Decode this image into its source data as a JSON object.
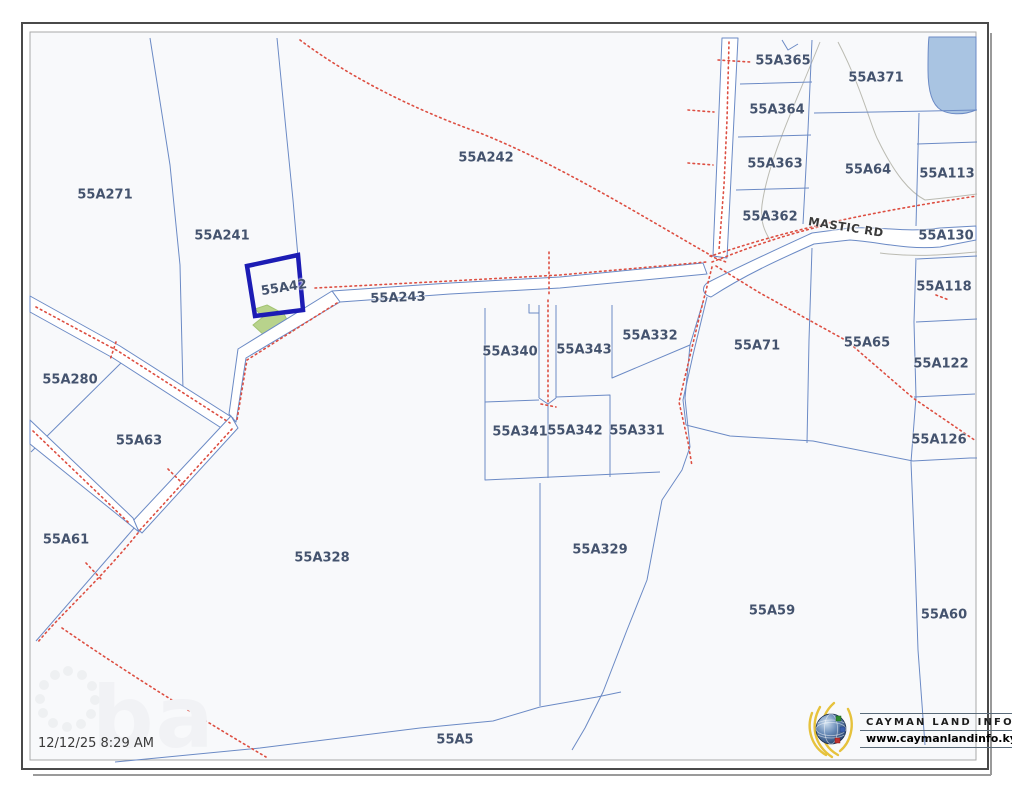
{
  "page": {
    "timestamp": "12/12/25 8:29 AM"
  },
  "branding": {
    "name": "CAYMAN LAND INFO",
    "url": "www.caymanlandinfo.ky"
  },
  "map": {
    "highlighted_parcel": "55A42",
    "colors": {
      "parcel_line": "#6b8ac5",
      "highlight": "#1c1cb4",
      "road_dotted": "#dd4f42",
      "water": "#a9c4e2",
      "vegetation": "#b8d38c",
      "label_text": "#44536e",
      "map_background": "#f8f9fb"
    },
    "road_labels": [
      {
        "text": "MASTIC RD",
        "x": 846,
        "y": 227,
        "rot": 9
      }
    ],
    "parcel_labels": [
      {
        "text": "55A271",
        "x": 105,
        "y": 195
      },
      {
        "text": "55A241",
        "x": 222,
        "y": 236
      },
      {
        "text": "55A242",
        "x": 486,
        "y": 158
      },
      {
        "text": "55A42",
        "x": 284,
        "y": 288,
        "rot": -9
      },
      {
        "text": "55A243",
        "x": 398,
        "y": 298,
        "rot": -2
      },
      {
        "text": "55A365",
        "x": 783,
        "y": 61
      },
      {
        "text": "55A371",
        "x": 876,
        "y": 78
      },
      {
        "text": "55A364",
        "x": 777,
        "y": 110
      },
      {
        "text": "55A363",
        "x": 775,
        "y": 164
      },
      {
        "text": "55A362",
        "x": 770,
        "y": 217
      },
      {
        "text": "55A64",
        "x": 868,
        "y": 170
      },
      {
        "text": "55A113",
        "x": 947,
        "y": 174
      },
      {
        "text": "55A130",
        "x": 946,
        "y": 236
      },
      {
        "text": "55A118",
        "x": 944,
        "y": 287
      },
      {
        "text": "55A122",
        "x": 941,
        "y": 364
      },
      {
        "text": "55A126",
        "x": 939,
        "y": 440
      },
      {
        "text": "55A65",
        "x": 867,
        "y": 343
      },
      {
        "text": "55A71",
        "x": 757,
        "y": 346
      },
      {
        "text": "55A340",
        "x": 510,
        "y": 352
      },
      {
        "text": "55A343",
        "x": 584,
        "y": 350
      },
      {
        "text": "55A332",
        "x": 650,
        "y": 336
      },
      {
        "text": "55A341",
        "x": 520,
        "y": 432
      },
      {
        "text": "55A342",
        "x": 575,
        "y": 431
      },
      {
        "text": "55A331",
        "x": 637,
        "y": 431
      },
      {
        "text": "55A280",
        "x": 70,
        "y": 380
      },
      {
        "text": "55A63",
        "x": 139,
        "y": 441
      },
      {
        "text": "55A61",
        "x": 66,
        "y": 540
      },
      {
        "text": "55A328",
        "x": 322,
        "y": 558
      },
      {
        "text": "55A329",
        "x": 600,
        "y": 550
      },
      {
        "text": "55A59",
        "x": 772,
        "y": 611
      },
      {
        "text": "55A60",
        "x": 944,
        "y": 615
      },
      {
        "text": "55A5",
        "x": 455,
        "y": 740
      }
    ]
  }
}
